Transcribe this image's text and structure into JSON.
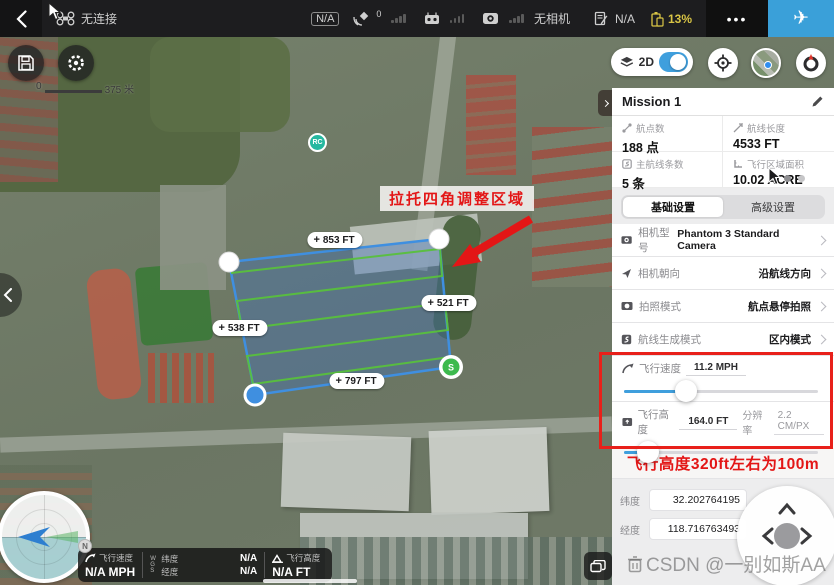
{
  "topbar": {
    "connection": "无连接",
    "mode_badge": "N/A",
    "gps_count": "0",
    "camera_label": "无相机",
    "record_badge": "N/A",
    "battery": "13%",
    "more": "•••"
  },
  "map": {
    "view_toggle": "2D",
    "scale_start": "0",
    "scale_end": "375 米",
    "banner": "拉托四角调整区域",
    "plus": "+",
    "edge_top": "853 FT",
    "edge_right": "521 FT",
    "edge_left": "538 FT",
    "edge_bottom": "797 FT",
    "start_marker": "S",
    "rc_marker": "RC",
    "compass_badge": "N"
  },
  "telemetry": {
    "speed_label": "飞行速度",
    "speed_value": "N/A MPH",
    "gps_axis": "WGS",
    "lat_label": "纬度",
    "lat_value": "N/A",
    "lng_label": "经度",
    "lng_value": "N/A",
    "alt_label": "飞行高度",
    "alt_value": "N/A FT"
  },
  "panel": {
    "title": "Mission 1",
    "stats": [
      {
        "label": "航点数",
        "value": "188 点"
      },
      {
        "label": "航线长度",
        "value": "4533 FT"
      },
      {
        "label": "主航线条数",
        "value": "5 条"
      },
      {
        "label": "飞行区域面积",
        "value": "10.02 ACRE"
      }
    ],
    "tabs": [
      {
        "label": "基础设置"
      },
      {
        "label": "高级设置"
      }
    ],
    "rows": [
      {
        "label": "相机型号",
        "value": "Phantom 3 Standard Camera"
      },
      {
        "label": "相机朝向",
        "value": "沿航线方向"
      },
      {
        "label": "拍照模式",
        "value": "航点悬停拍照"
      },
      {
        "label": "航线生成模式",
        "value": "区内模式"
      }
    ],
    "speed": {
      "label": "飞行速度",
      "value": "11.2 MPH"
    },
    "altitude": {
      "label": "飞行高度",
      "value": "164.0 FT",
      "res_label": "分辨率",
      "res_value": "2.2 CM/PX"
    },
    "annotation": "飞行高度320ft左右为100m",
    "coords": {
      "lat_label": "纬度",
      "lat_value": "32.202764195",
      "lng_label": "经度",
      "lng_value": "118.716763493"
    }
  },
  "watermark": "CSDN @一别如斯AA"
}
